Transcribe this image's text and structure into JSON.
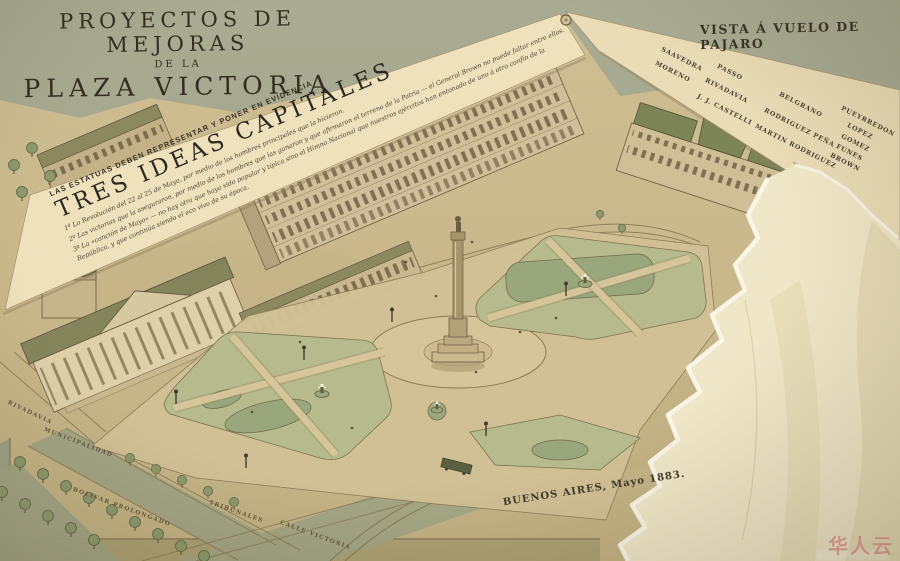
{
  "title": {
    "line1": "PROYECTOS DE MEJORAS",
    "line2": "DE LA",
    "line3": "PLAZA VICTORIA"
  },
  "view_label": "VISTA Á VUELO DE PAJARO",
  "date_caption": "BUENOS AIRES, Mayo 1883.",
  "banner": {
    "kicker": "LAS ESTATUAS DEBEN REPRESENTAR Y PONER EN EVIDENCIA",
    "heading": "TRES IDEAS CAPITALES",
    "items": [
      "1º  La Revolución del 22 al 25 de Mayo, por medio de los hombres principales que la hicieron.",
      "2º  Las victorias que la aseguraron, por medio de los hombres que las ganaron y que afirmaron el terreno de la Patria — el General Brown no puede faltar entre ellos.",
      "3º  La «canción de Mayo» — no hay otra que haya sido popular y típica sino el Himno Nacional que nuestros ejércitos han entonado de uno á otro confín de la República, y que continúa siendo el eco vivo de su época."
    ]
  },
  "plaque_names": [
    "SAAVEDRA",
    "MORENO",
    "PASSO",
    "RIVADAVIA",
    "J. J. CASTELLI",
    "BELGRANO",
    "RODRIGUEZ PEÑA",
    "MARTIN RODRIGUEZ",
    "PUEYRREDON",
    "LOPEZ",
    "GOMEZ",
    "FUNES",
    "BROWN"
  ],
  "street_labels": [
    "RIVADAVIA",
    "MUNICIPALIDAD",
    "BOLIVAR PROLONGADO",
    "TRIBUNALES",
    "CALLE VICTORIA"
  ],
  "watermark": {
    "text": "华人云"
  },
  "palette": {
    "backdrop": "#a5a78d",
    "map_paper": "#c9b88c",
    "overlay_paper": "#eadcb5",
    "lawn_green": "#b7ba8c",
    "pond_green": "#9aa67c",
    "roof_olive": "#8b895e",
    "ink": "#372f22",
    "torn_backing": "#f0e6c8",
    "watermark_red": "#cf6a5c"
  }
}
